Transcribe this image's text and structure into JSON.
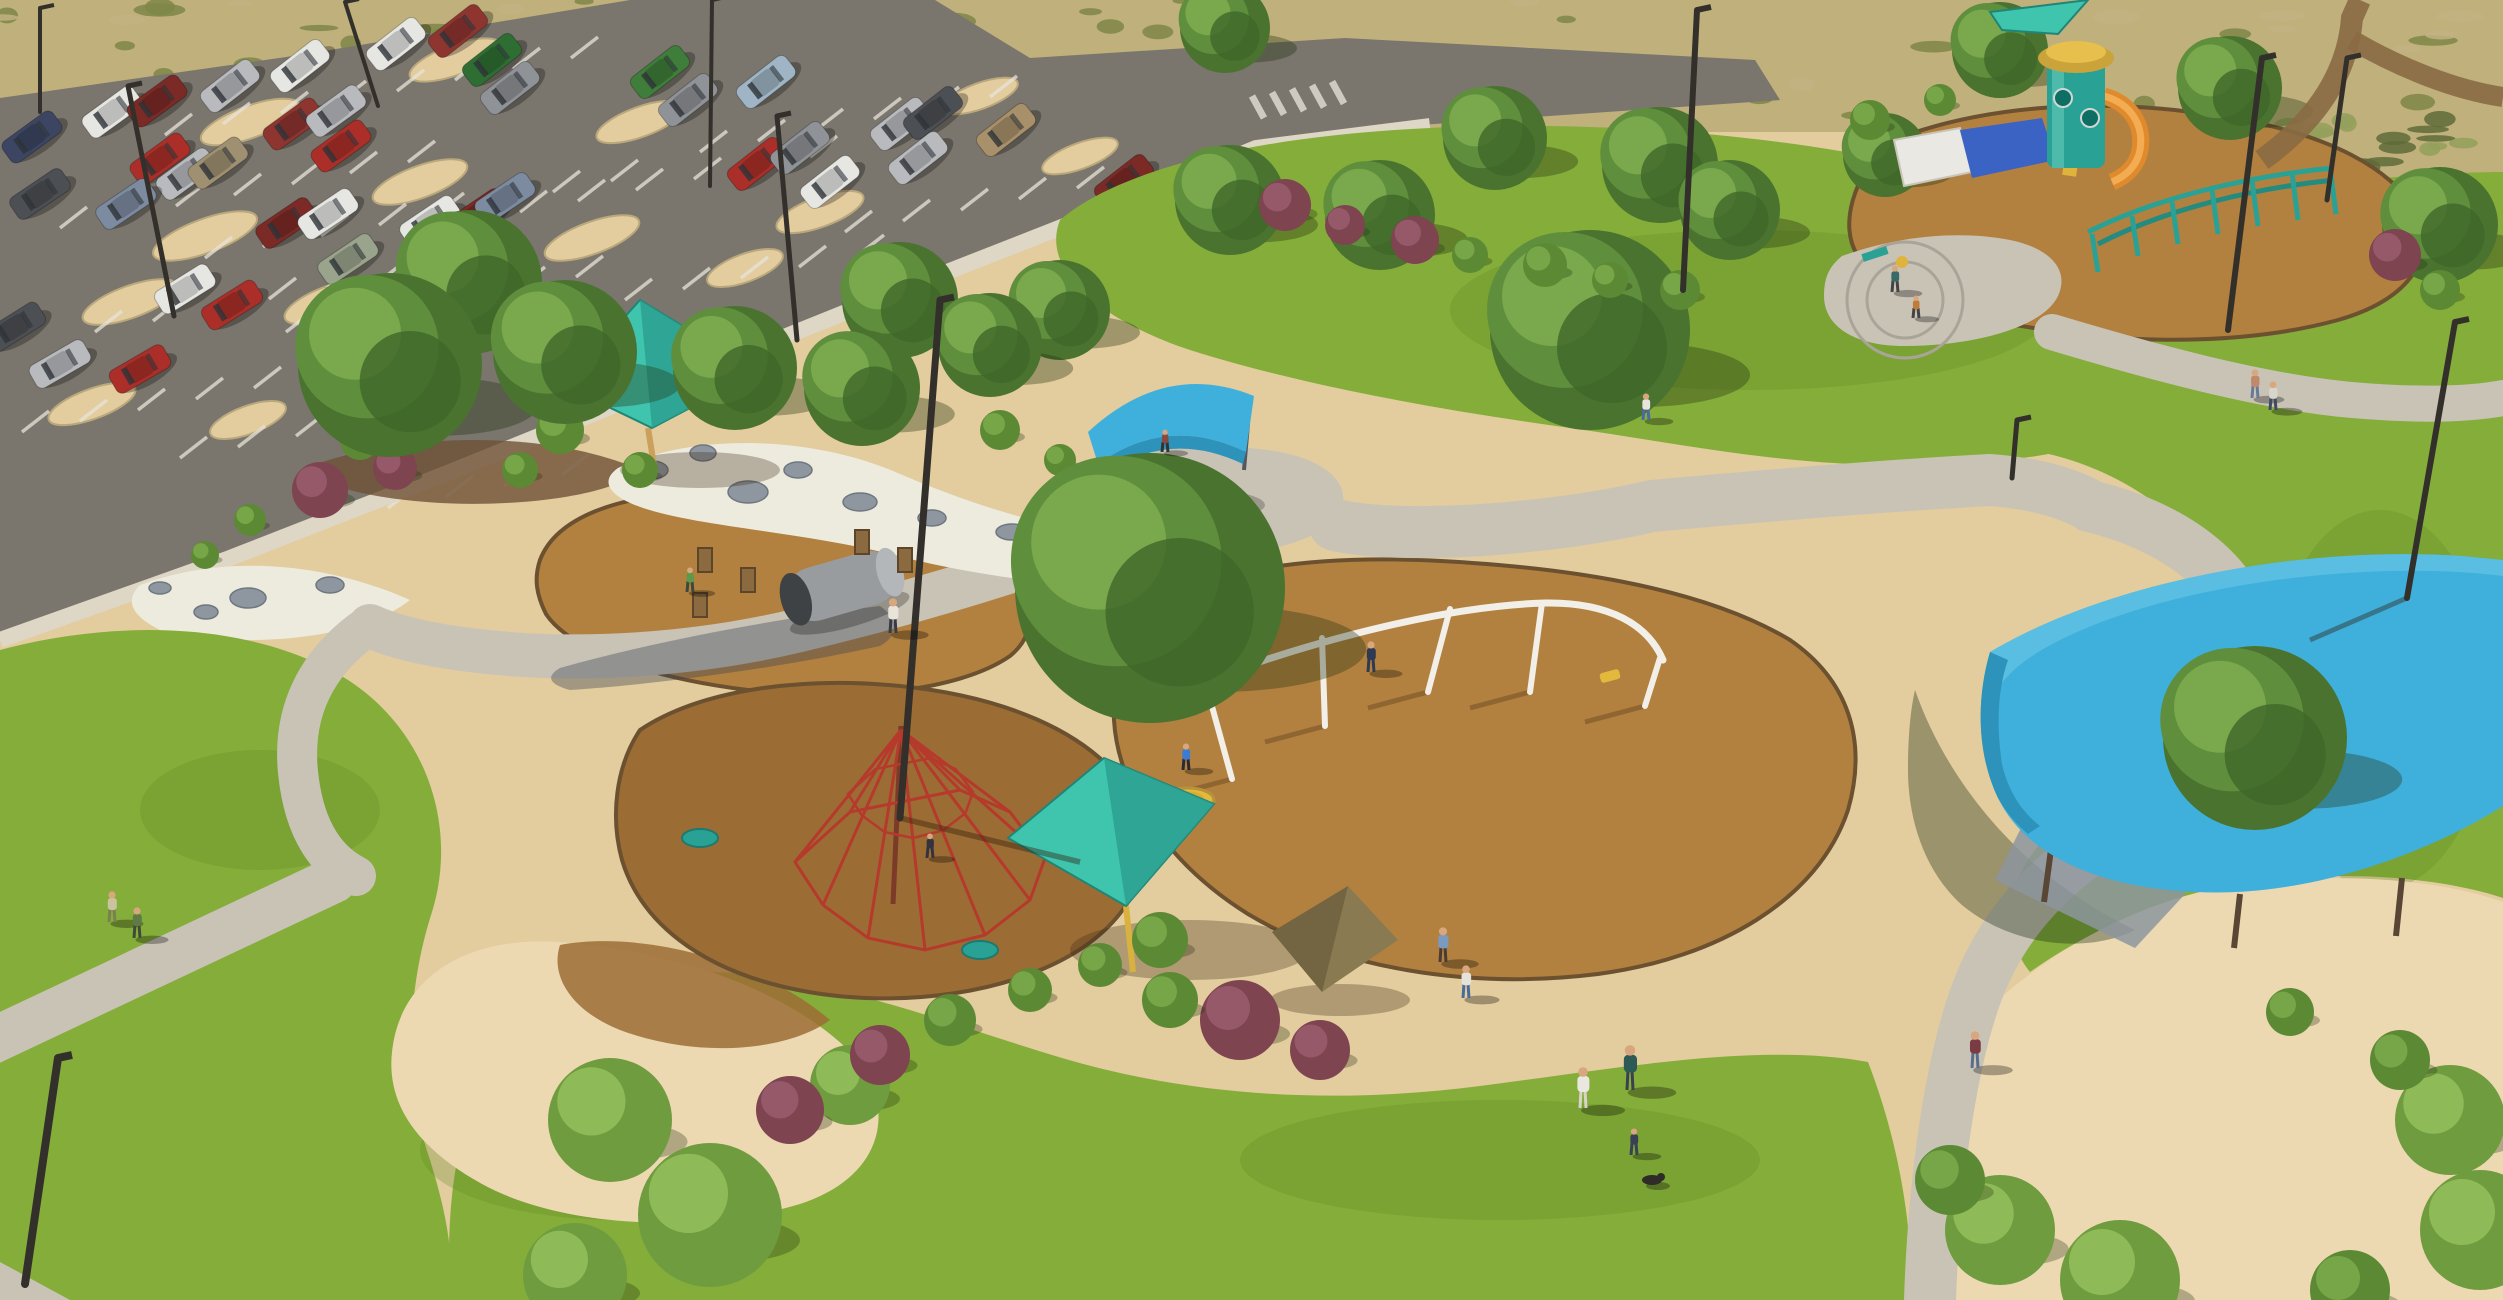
{
  "meta": {
    "title": "Aerial rendering of a community park: parking lot, playgrounds with teal shade sails, swings, lawns and walking paths",
    "width": 2503,
    "height": 1300
  },
  "palette": {
    "dg": "#e3cc9e",
    "dg_light": "#ecd9b2",
    "desert": "#bfb07c",
    "asphalt": "#7a756d",
    "walk": "#c9c3b6",
    "walk_light": "#ded7c5",
    "grass": "#85ad3a",
    "grass_dark": "#5e8a28",
    "mulch": "#b3813f",
    "mulch_dark": "#9c6c35",
    "mulch_edge": "#6b5130",
    "rock_white": "#edebdd",
    "boulder": "#8e96a0",
    "soil": "#6f5136",
    "teal_sail": "#3fc4ae",
    "teal_sail_dark": "#2da190",
    "teal_sail_light": "#5fd4bf",
    "blue_canopy": "#3fb0dc",
    "blue_canopy_dark": "#2e93ba",
    "blue_canopy_light": "#66c4e6",
    "play_teal": "#2aa195",
    "play_yellow": "#e0b33c",
    "play_orange": "#e08a2e",
    "play_blue": "#3a63c4",
    "canopy_white": "#eae8e2",
    "red_net": "#b53a2c",
    "swing_white": "#f2efe8",
    "pole_brown": "#4a3a2a",
    "skin": "#d9a77e",
    "tree_dark": "#4a7330",
    "tree_mid": "#5f8f3c",
    "tree_light": "#79a94c",
    "stripe_white": "#e8e4da"
  },
  "desert_tufts": {
    "count": 150,
    "seed": 11,
    "regions": [
      [
        0,
        0,
        2503,
        118
      ],
      [
        2250,
        118,
        253,
        230
      ]
    ],
    "colors": [
      "#7e8748",
      "#5e6b38",
      "#c2b282",
      "#93a05a"
    ]
  },
  "parking": {
    "islands": [
      [
        250,
        122,
        52,
        16
      ],
      [
        455,
        60,
        48,
        15
      ],
      [
        205,
        236,
        55,
        17
      ],
      [
        420,
        182,
        50,
        16
      ],
      [
        640,
        122,
        46,
        15
      ],
      [
        592,
        238,
        50,
        16
      ],
      [
        820,
        212,
        46,
        15
      ],
      [
        130,
        302,
        50,
        16
      ],
      [
        330,
        302,
        48,
        16
      ],
      [
        92,
        404,
        46,
        15
      ],
      [
        248,
        420,
        40,
        14
      ],
      [
        540,
        330,
        42,
        14
      ],
      [
        745,
        268,
        40,
        14
      ],
      [
        980,
        96,
        40,
        13
      ],
      [
        1080,
        156,
        40,
        13
      ]
    ],
    "stripe_rows": [
      [
        165,
        135,
        58,
        -11,
        8
      ],
      [
        60,
        228,
        58,
        -11,
        7
      ],
      [
        205,
        258,
        58,
        -11,
        8
      ],
      [
        95,
        332,
        58,
        -11,
        7
      ],
      [
        286,
        332,
        58,
        -11,
        6
      ],
      [
        520,
        212,
        58,
        -11,
        6
      ],
      [
        625,
        300,
        58,
        -11,
        5
      ],
      [
        700,
        152,
        58,
        -11,
        6
      ],
      [
        845,
        232,
        58,
        -11,
        5
      ],
      [
        22,
        432,
        58,
        -11,
        5
      ],
      [
        180,
        458,
        58,
        -11,
        5
      ],
      [
        388,
        508,
        58,
        -11,
        4
      ]
    ],
    "crosswalk": {
      "x": 1252,
      "y": 96,
      "dx": 20,
      "dy": -3.6,
      "n": 5
    }
  },
  "cars": [
    [
      300,
      66,
      -38,
      "#e6e6e3"
    ],
    [
      230,
      86,
      -38,
      "#b8babd"
    ],
    [
      396,
      44,
      -38,
      "#e6e6e3"
    ],
    [
      458,
      31,
      -38,
      "#8e3530"
    ],
    [
      492,
      60,
      -38,
      "#2f6e33"
    ],
    [
      510,
      88,
      -38,
      "#8f9296"
    ],
    [
      660,
      72,
      -38,
      "#3f7d3a"
    ],
    [
      688,
      100,
      -38,
      "#8f9296"
    ],
    [
      766,
      82,
      -38,
      "#9fb4c4"
    ],
    [
      900,
      124,
      -38,
      "#b8babd"
    ],
    [
      933,
      113,
      -38,
      "#4c4f54"
    ],
    [
      1006,
      130,
      -38,
      "#a8906a"
    ],
    [
      918,
      158,
      -38,
      "#b8babd"
    ],
    [
      757,
      164,
      -38,
      "#ab2f28"
    ],
    [
      800,
      148,
      -38,
      "#8f9296"
    ],
    [
      830,
      182,
      -38,
      "#e6e6e3"
    ],
    [
      1124,
      181,
      -38,
      "#7c2a25"
    ],
    [
      112,
      112,
      -36,
      "#e6e6e3"
    ],
    [
      157,
      101,
      -36,
      "#7c2a25"
    ],
    [
      32,
      137,
      -36,
      "#3c4663"
    ],
    [
      160,
      159,
      -36,
      "#ab2f28"
    ],
    [
      186,
      174,
      -36,
      "#b8babd"
    ],
    [
      218,
      163,
      -36,
      "#9f9071"
    ],
    [
      293,
      124,
      -36,
      "#8e3530"
    ],
    [
      336,
      111,
      -36,
      "#b8babd"
    ],
    [
      341,
      146,
      -36,
      "#ab2f28"
    ],
    [
      40,
      194,
      -34,
      "#4c4f54"
    ],
    [
      126,
      204,
      -34,
      "#7d8ba0"
    ],
    [
      286,
      223,
      -34,
      "#7c2a25"
    ],
    [
      328,
      214,
      -34,
      "#e6e6e3"
    ],
    [
      348,
      259,
      -34,
      "#9aa38c"
    ],
    [
      430,
      221,
      -34,
      "#e6e6e3"
    ],
    [
      478,
      214,
      -34,
      "#7c2a25"
    ],
    [
      505,
      198,
      -34,
      "#7d8ba0"
    ],
    [
      185,
      289,
      -32,
      "#e6e6e3"
    ],
    [
      232,
      305,
      -32,
      "#ab2f28"
    ],
    [
      15,
      327,
      -32,
      "#4c4f54"
    ],
    [
      60,
      364,
      -30,
      "#b8babd"
    ],
    [
      140,
      369,
      -30,
      "#ab2f28"
    ]
  ],
  "trees": {
    "back": [
      [
        1225,
        28,
        45
      ],
      [
        1230,
        200,
        55
      ],
      [
        1380,
        215,
        55
      ],
      [
        1495,
        138,
        52
      ],
      [
        1660,
        165,
        58
      ],
      [
        1730,
        210,
        50
      ],
      [
        2000,
        50,
        48
      ],
      [
        2230,
        88,
        52
      ],
      [
        2440,
        225,
        58
      ],
      [
        1885,
        155,
        42
      ],
      [
        1590,
        330,
        100
      ],
      [
        470,
        282,
        72
      ],
      [
        900,
        300,
        58
      ],
      [
        1060,
        310,
        50
      ]
    ],
    "front": [
      [
        390,
        365,
        92
      ],
      [
        565,
        352,
        72
      ],
      [
        735,
        368,
        62
      ],
      [
        862,
        388,
        58
      ],
      [
        990,
        345,
        52
      ],
      [
        1150,
        588,
        135
      ],
      [
        2255,
        738,
        92
      ]
    ]
  },
  "shrubs": [
    [
      320,
      490,
      28,
      "b"
    ],
    [
      395,
      468,
      22,
      "b"
    ],
    [
      360,
      440,
      20,
      "g"
    ],
    [
      640,
      470,
      18,
      "g"
    ],
    [
      250,
      520,
      16,
      "g"
    ],
    [
      205,
      555,
      14,
      "g"
    ],
    [
      1285,
      205,
      26,
      "b"
    ],
    [
      1345,
      225,
      20,
      "b"
    ],
    [
      1415,
      240,
      24,
      "b"
    ],
    [
      1470,
      255,
      18,
      "g"
    ],
    [
      1545,
      265,
      22,
      "g"
    ],
    [
      1610,
      280,
      18,
      "g"
    ],
    [
      1680,
      290,
      20,
      "g"
    ],
    [
      2395,
      255,
      26,
      "b"
    ],
    [
      2440,
      290,
      20,
      "g"
    ],
    [
      1870,
      120,
      20,
      "g"
    ],
    [
      1940,
      100,
      16,
      "g"
    ],
    [
      2290,
      1012,
      24,
      "g"
    ],
    [
      610,
      1120,
      62,
      "gl"
    ],
    [
      710,
      1215,
      72,
      "gl"
    ],
    [
      575,
      1275,
      52,
      "gl"
    ],
    [
      850,
      1085,
      40,
      "gl"
    ],
    [
      880,
      1055,
      30,
      "b"
    ],
    [
      790,
      1110,
      34,
      "b"
    ],
    [
      950,
      1020,
      26,
      "g"
    ],
    [
      1030,
      990,
      22,
      "g"
    ],
    [
      1240,
      1020,
      40,
      "b"
    ],
    [
      1320,
      1050,
      30,
      "b"
    ],
    [
      1170,
      1000,
      28,
      "g"
    ],
    [
      2000,
      1230,
      55,
      "gl"
    ],
    [
      2120,
      1280,
      60,
      "gl"
    ],
    [
      1950,
      1180,
      35,
      "g"
    ],
    [
      2450,
      1120,
      55,
      "gl"
    ],
    [
      2480,
      1230,
      60,
      "gl"
    ],
    [
      2400,
      1060,
      30,
      "g"
    ],
    [
      2350,
      1290,
      40,
      "g"
    ],
    [
      560,
      430,
      24,
      "g"
    ],
    [
      520,
      470,
      18,
      "g"
    ],
    [
      1000,
      430,
      20,
      "g"
    ],
    [
      1060,
      460,
      16,
      "g"
    ],
    [
      1160,
      940,
      28,
      "g"
    ],
    [
      1100,
      965,
      22,
      "g"
    ]
  ],
  "boulders": [
    [
      652,
      470,
      16,
      9
    ],
    [
      703,
      453,
      13,
      8
    ],
    [
      748,
      492,
      20,
      11
    ],
    [
      798,
      470,
      14,
      8
    ],
    [
      860,
      502,
      17,
      9
    ],
    [
      932,
      518,
      14,
      8
    ],
    [
      1012,
      532,
      16,
      8
    ],
    [
      1092,
      543,
      13,
      7
    ],
    [
      1162,
      556,
      15,
      8
    ],
    [
      1218,
      570,
      12,
      7
    ],
    [
      248,
      598,
      18,
      10
    ],
    [
      330,
      585,
      14,
      8
    ],
    [
      206,
      612,
      12,
      7
    ],
    [
      160,
      588,
      11,
      6
    ]
  ],
  "poles": [
    [
      40,
      8,
      40,
      112,
      4
    ],
    [
      128,
      86,
      174,
      316,
      5
    ],
    [
      345,
      2,
      378,
      106,
      4
    ],
    [
      712,
      0,
      710,
      186,
      4
    ],
    [
      777,
      116,
      797,
      340,
      5
    ],
    [
      940,
      300,
      900,
      818,
      7,
      1080,
      862
    ],
    [
      2455,
      322,
      2407,
      598,
      6,
      2310,
      640
    ],
    [
      2262,
      58,
      2228,
      330,
      6
    ],
    [
      2347,
      58,
      2327,
      200,
      5
    ],
    [
      58,
      1058,
      25,
      1284,
      8
    ],
    [
      2017,
      420,
      2012,
      478,
      5
    ],
    [
      1697,
      10,
      1683,
      290,
      6
    ]
  ],
  "swing": {
    "rail": "M1203,682 C1300,645 1440,606 1545,603 C1610,602 1648,625 1663,660",
    "legs": [
      [
        1205,
        681,
        1232,
        779
      ],
      [
        1322,
        638,
        1325,
        726
      ],
      [
        1450,
        609,
        1428,
        692
      ],
      [
        1542,
        603,
        1530,
        692
      ],
      [
        1660,
        658,
        1645,
        706
      ]
    ],
    "saucer": [
      1188,
      800,
      26,
      12
    ],
    "belt_seat": [
      1610,
      676
    ]
  },
  "spider": {
    "apex": [
      901,
      726
    ],
    "pole_base": [
      893,
      904
    ],
    "base_ring": [
      [
        795,
        862
      ],
      [
        823,
        905
      ],
      [
        868,
        938
      ],
      [
        925,
        950
      ],
      [
        985,
        935
      ],
      [
        1030,
        900
      ],
      [
        1045,
        858
      ],
      [
        1010,
        812
      ],
      [
        960,
        790
      ],
      [
        850,
        812
      ]
    ],
    "seats": [
      [
        700,
        838
      ],
      [
        980,
        950
      ]
    ]
  },
  "sails": [
    {
      "pts": [
        [
          640,
          300
        ],
        [
          563,
          385
        ],
        [
          652,
          428
        ],
        [
          758,
          372
        ]
      ],
      "facet": [
        [
          640,
          300
        ],
        [
          758,
          372
        ],
        [
          652,
          428
        ]
      ],
      "kind": "teal",
      "pole": [
        648,
        428,
        655,
        472,
        "#caa05a"
      ],
      "shadow": [
        700,
        470,
        80,
        18
      ]
    },
    {
      "pts": [
        [
          1008,
          838
        ],
        [
          1104,
          758
        ],
        [
          1214,
          804
        ],
        [
          1126,
          906
        ]
      ],
      "facet": [
        [
          1104,
          758
        ],
        [
          1214,
          804
        ],
        [
          1126,
          906
        ]
      ],
      "kind": "teal",
      "pole": [
        1126,
        906,
        1133,
        972,
        "#d9b13f"
      ],
      "shadow": [
        1190,
        950,
        120,
        30
      ]
    },
    {
      "pts": [
        [
          1272,
          932
        ],
        [
          1348,
          886
        ],
        [
          1398,
          940
        ],
        [
          1322,
          992
        ]
      ],
      "facet": [
        [
          1272,
          932
        ],
        [
          1348,
          886
        ],
        [
          1322,
          992
        ]
      ],
      "kind": "brown",
      "shadow": [
        1340,
        1000,
        70,
        16
      ]
    },
    {
      "pts": [
        [
          1990,
          12
        ],
        [
          2088,
          0
        ],
        [
          2058,
          34
        ],
        [
          2002,
          30
        ]
      ],
      "kind": "teal"
    }
  ],
  "people": [
    [
      893,
      633,
      34,
      "#e8e4da",
      "#3a3a44"
    ],
    [
      1186,
      770,
      26,
      "#3a7bd5",
      "#2a2a33"
    ],
    [
      1371,
      672,
      30,
      "#2e3a52",
      "#2e3a52"
    ],
    [
      690,
      592,
      24,
      "#5a9a4a",
      "#3a4a3a"
    ],
    [
      930,
      858,
      24,
      "#33333d",
      "#33333d"
    ],
    [
      1443,
      962,
      34,
      "#7a9ac0",
      "#4a3b33"
    ],
    [
      1466,
      998,
      32,
      "#e5e2da",
      "#4a6a9a"
    ],
    [
      1583,
      1108,
      40,
      "#eae7e0",
      "#d8d4ca"
    ],
    [
      1630,
      1090,
      44,
      "#2e5a55",
      "#3a4050"
    ],
    [
      1634,
      1155,
      26,
      "#384055",
      "#384055"
    ],
    [
      1975,
      1068,
      36,
      "#7a3b44",
      "#5a6e8c"
    ],
    [
      112,
      922,
      30,
      "#c9c3a0",
      "#7a8050"
    ],
    [
      137,
      938,
      30,
      "#5f7a44",
      "#3f4a3a"
    ],
    [
      1895,
      292,
      26,
      "#3a6a66",
      "#444444"
    ],
    [
      1916,
      318,
      22,
      "#c07a3a",
      "#444444"
    ],
    [
      2255,
      398,
      28,
      "#c08a6a",
      "#6a7a96"
    ],
    [
      2273,
      410,
      28,
      "#d8d5cc",
      "#3e4a62"
    ],
    [
      1646,
      420,
      26,
      "#e8e5dc",
      "#4a6aa0"
    ],
    [
      1165,
      452,
      22,
      "#8a4a3f",
      "#333333"
    ]
  ],
  "dog": [
    1652,
    1180
  ]
}
